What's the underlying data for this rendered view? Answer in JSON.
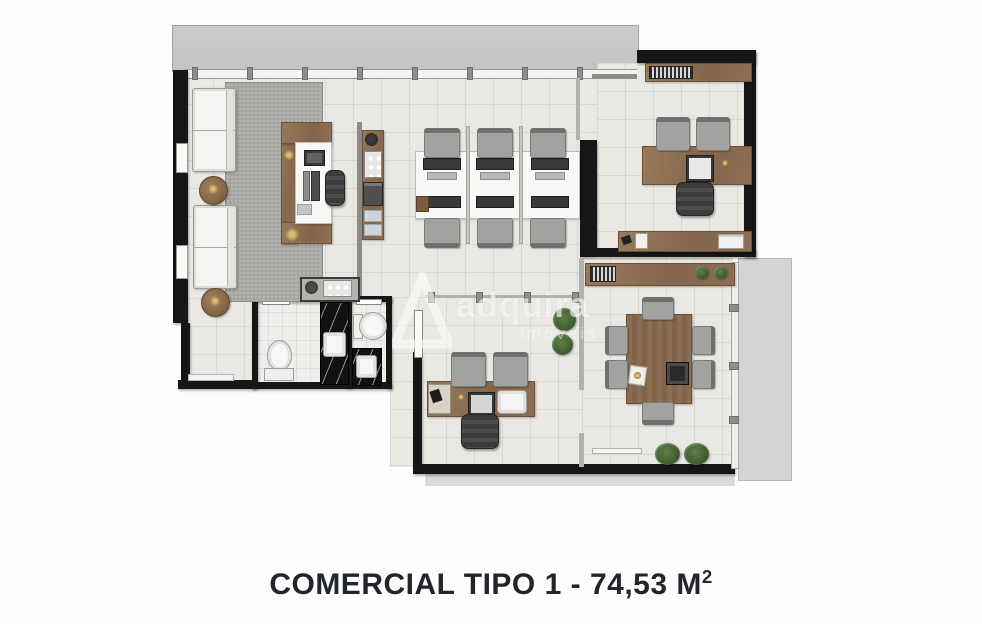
{
  "caption": {
    "label": "COMERCIAL TIPO 1 - 74,53 M",
    "sup": "2"
  },
  "watermark": {
    "brand": "adquira",
    "sub": "imóveis"
  },
  "plan": {
    "colors": {
      "wall": "#161616",
      "floor_tile": "#eae8e3",
      "balcony_gray": "#c9c8c6",
      "terrace_gray": "#d5d4d2",
      "wood": "#8a6d50",
      "rug_gray": "#a7a6a3",
      "marble_black": "#111111",
      "plant_green": "#3b5a2c",
      "caption_text": "#22262b",
      "watermark_white": "rgba(255,255,255,0.6)"
    }
  }
}
